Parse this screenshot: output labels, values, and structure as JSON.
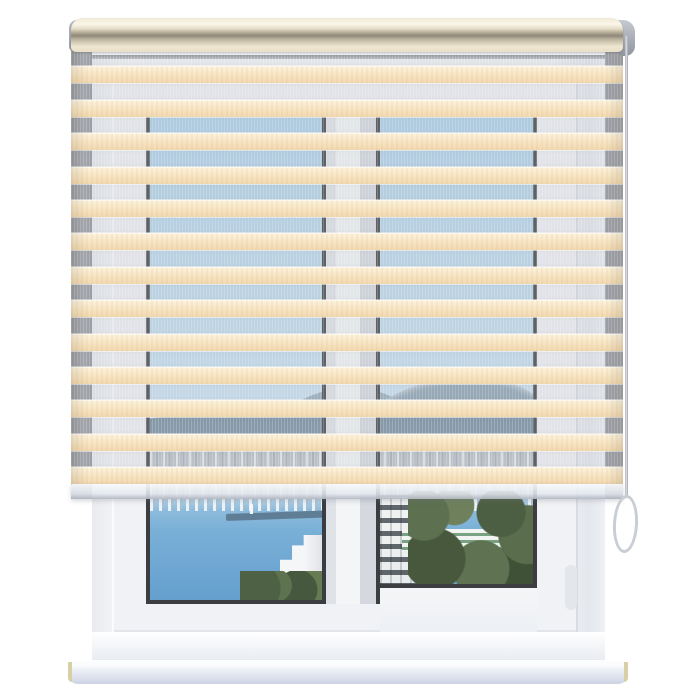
{
  "image": {
    "kind": "product-photo",
    "subject": "zebra day-night roller blind mounted on a white pvc window",
    "background": "#ffffff"
  },
  "blind": {
    "stripe_pairs": 13,
    "control_side": "right",
    "parts": [
      "cassette",
      "fabric-stripes",
      "sheer-stripes",
      "bottom-bar",
      "chain",
      "chain-loop"
    ]
  },
  "window": {
    "pane_count": 2,
    "parts": [
      "niche",
      "frame",
      "mullion",
      "glass",
      "sill"
    ]
  },
  "view_elements": [
    "sky",
    "snowy-mountains",
    "hillside",
    "coastal-town",
    "sea-bay",
    "breakwater-pier",
    "lighthouse",
    "white-buildings",
    "trees"
  ],
  "colors": {
    "page-bg": "#ffffff",
    "fabric": "#f7e4c2",
    "fabric-light": "#fdf3dd",
    "fabric-dark": "#f1d8af",
    "sheer-veil": "rgba(185,189,197,0.28)",
    "sky-top": "#a9cfe9",
    "sky-bottom": "#c8e1f1",
    "sea-top": "#7ab0d7",
    "sea-deep": "#649fce",
    "chain": "#c9cdd4",
    "sill-cap": "#d8cfa6"
  }
}
